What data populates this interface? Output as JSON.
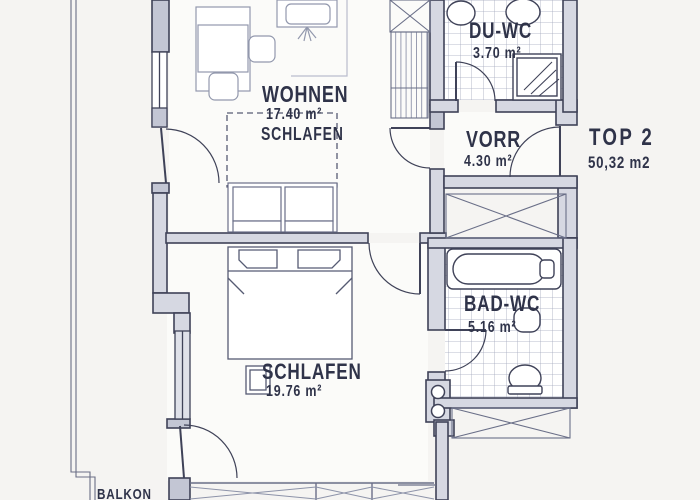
{
  "plan": {
    "unit": {
      "label": "TOP 2",
      "area": "50,32 m2"
    },
    "rooms": {
      "wohnen": {
        "name": "WOHNEN",
        "area": "17.40 m²",
        "subname": "SCHLAFEN"
      },
      "duwc": {
        "name": "DU-WC",
        "area": "3.70 m²"
      },
      "vorr": {
        "name": "VORR",
        "area": "4.30 m²"
      },
      "badwc": {
        "name": "BAD-WC",
        "area": "5.16 m²"
      },
      "schlafen": {
        "name": "SCHLAFEN",
        "area": "19.76 m²"
      },
      "balkon": {
        "name": "BALKON"
      }
    },
    "colors": {
      "background": "#f5f4f2",
      "wall_fill": "#d6d8e2",
      "wall_fill_dark": "#c3c6d4",
      "line": "#3f4258",
      "furniture_line": "#9298ad",
      "bed_line": "#565b73",
      "tile_line": "#a3a8bc",
      "text": "#2f3349"
    }
  }
}
